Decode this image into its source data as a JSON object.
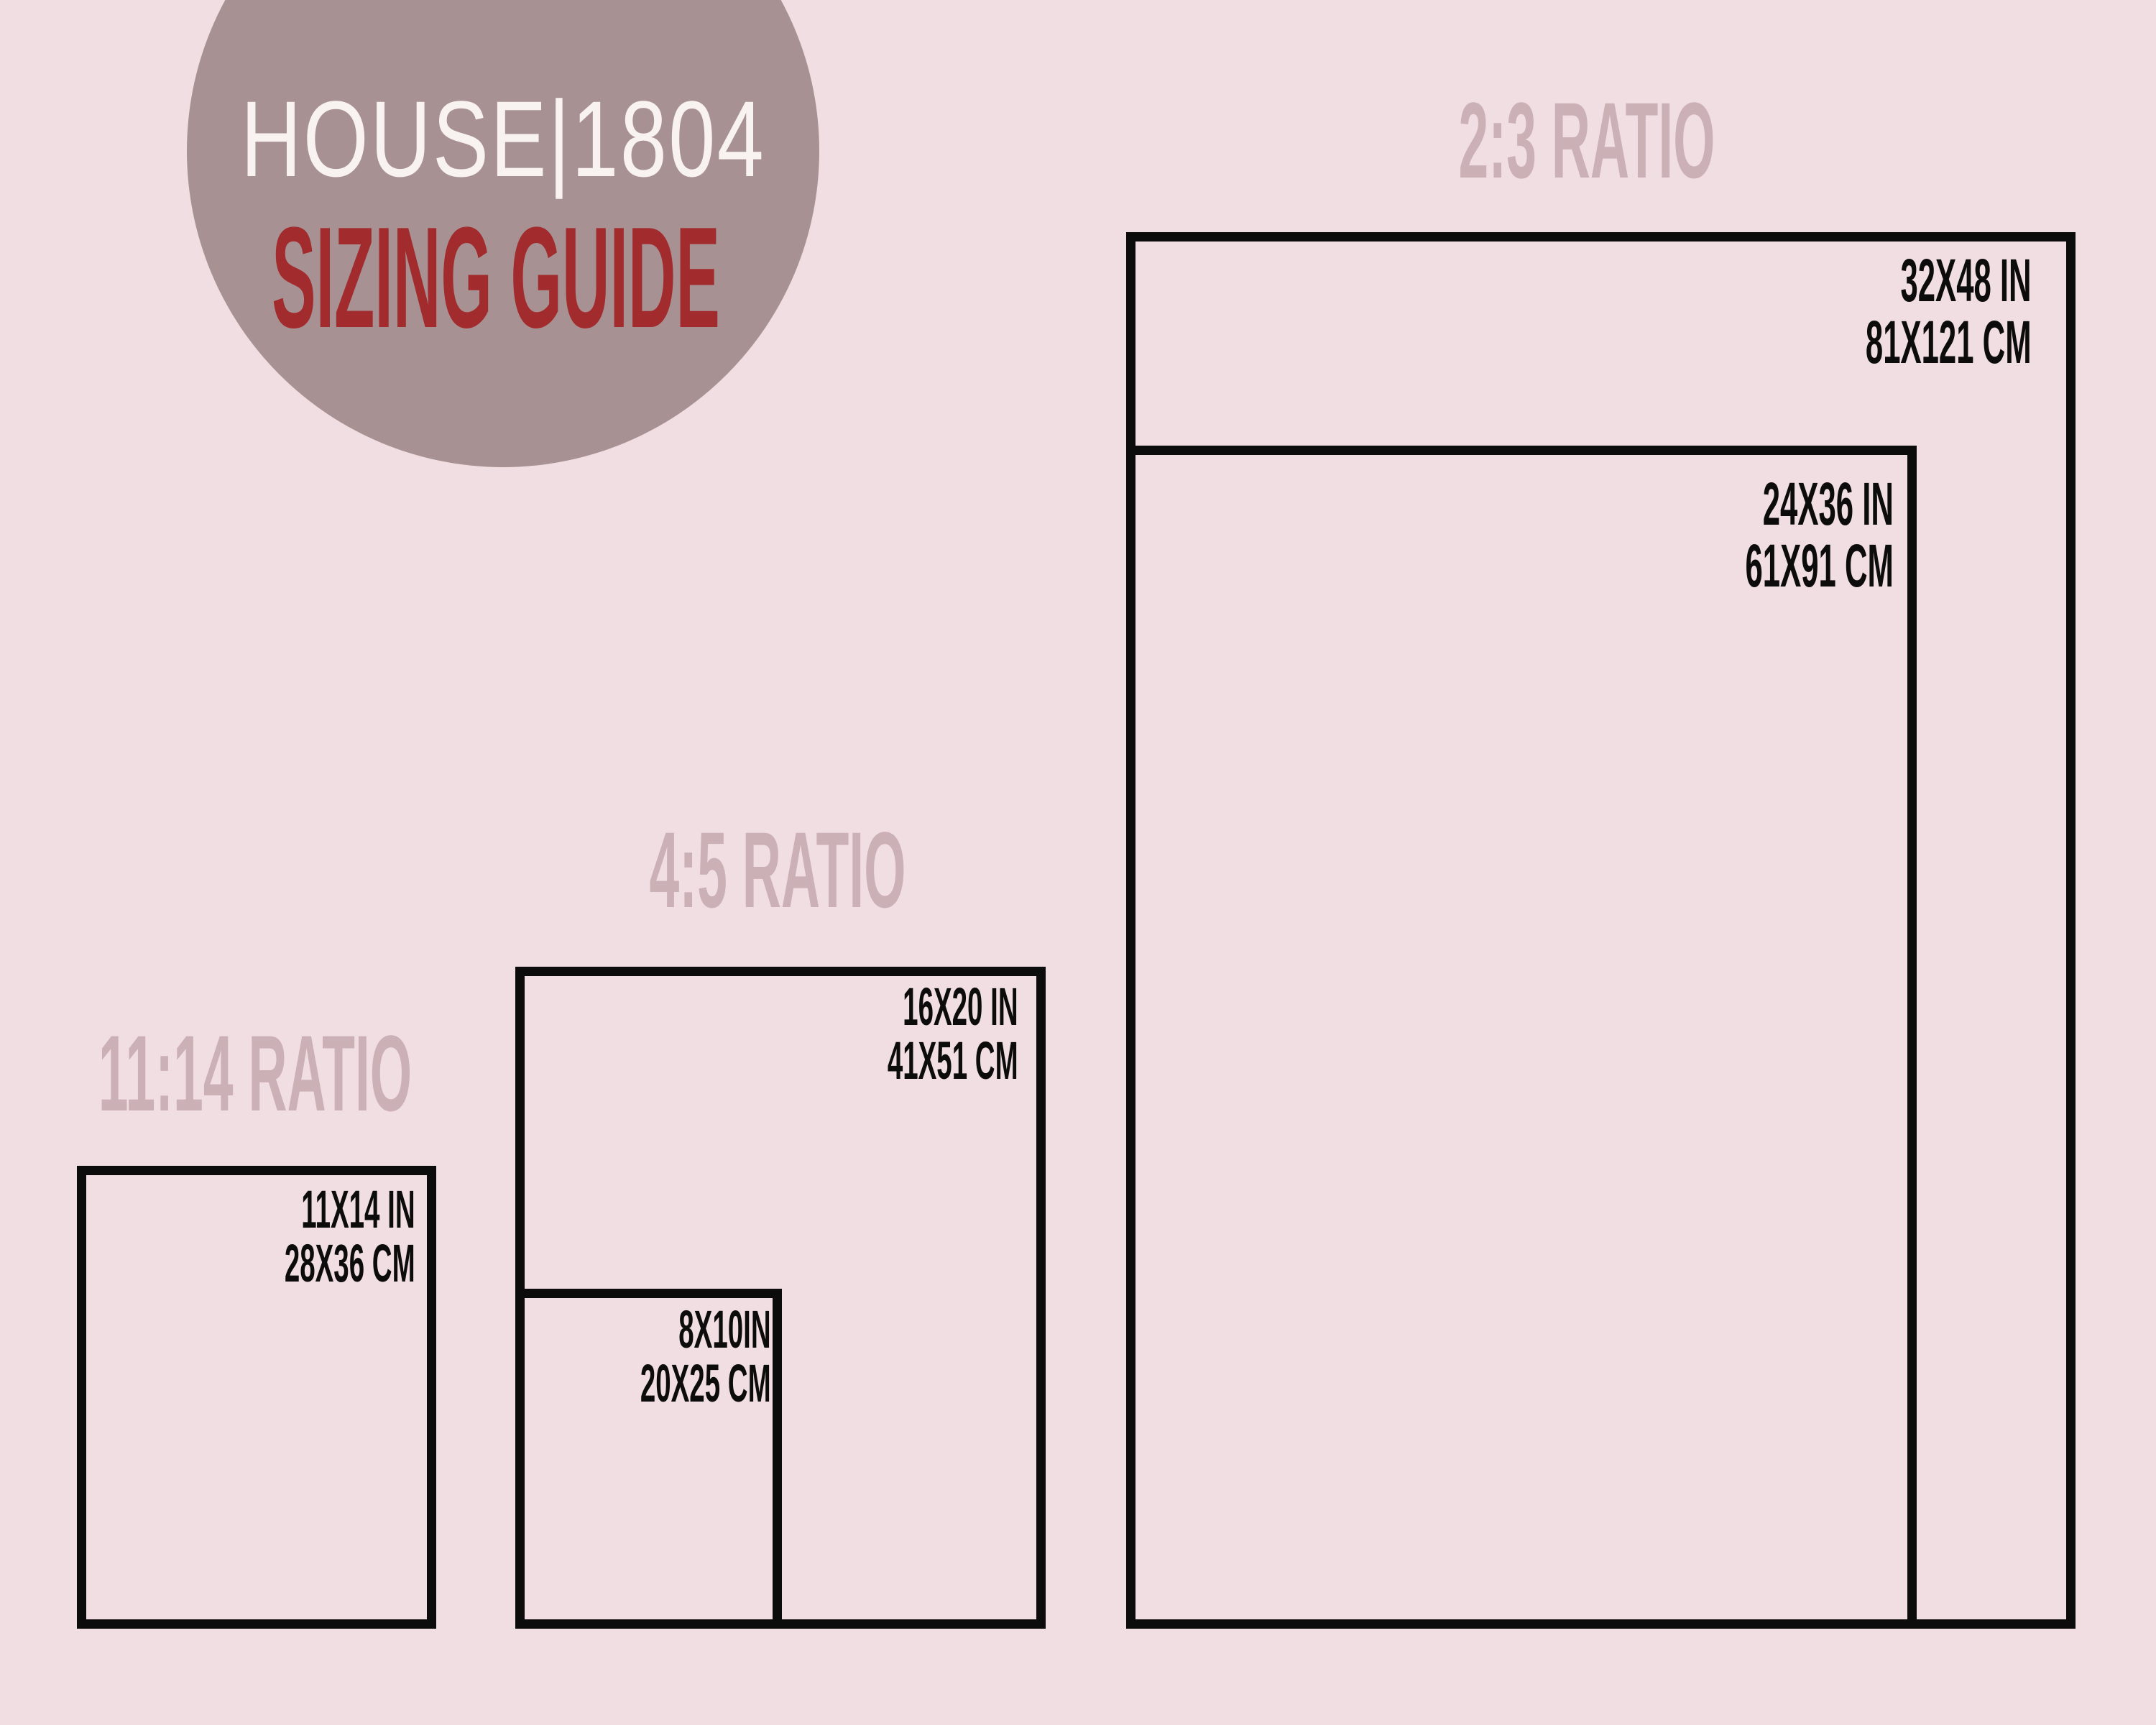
{
  "logo": {
    "brand": "HOUSE|1804",
    "subtitle": "SIZING GUIDE"
  },
  "colors": {
    "background": "#f0dee2",
    "logo_circle": "#a89193",
    "brand_text": "#f8f3f1",
    "accent_red": "#a12b2d",
    "ratio_heading": "#cbb0b5",
    "outline_black": "#0d0c0c"
  },
  "groups": [
    {
      "heading": "2:3 RATIO",
      "sizes": [
        {
          "inches": "32X48 IN",
          "cm": "81X121 CM"
        },
        {
          "inches": "24X36 IN",
          "cm": "61X91 CM"
        }
      ]
    },
    {
      "heading": "4:5 RATIO",
      "sizes": [
        {
          "inches": "16X20 IN",
          "cm": "41X51 CM"
        },
        {
          "inches": "8X10IN",
          "cm": "20X25 CM"
        }
      ]
    },
    {
      "heading": "11:14 RATIO",
      "sizes": [
        {
          "inches": "11X14 IN",
          "cm": "28X36 CM"
        }
      ]
    }
  ]
}
